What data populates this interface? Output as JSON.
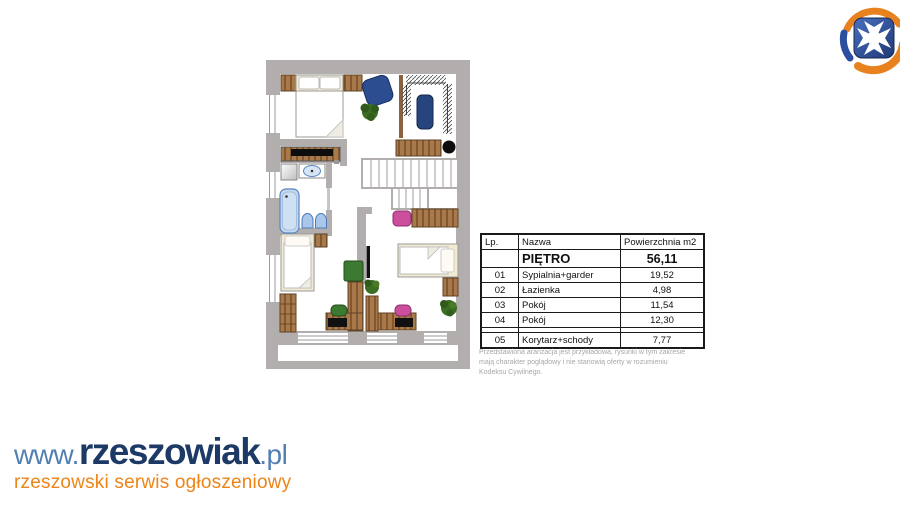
{
  "colors": {
    "wall_gray": "#b3aeae",
    "wood": "#a8794a",
    "navy": "#1d3a66",
    "steel_blue": "#527fb3",
    "orange": "#ee8418",
    "pink": "#cb4f9d",
    "green": "#3d7a31",
    "furniture_blue": "#2c4d8f",
    "bath_blue": "#c3d7ee"
  },
  "floor_plan": {
    "title": "PIĘTRO",
    "total_area_m2": "56,11"
  },
  "table": {
    "headers": [
      "Lp.",
      "Nazwa",
      "Powierzchnia m2"
    ],
    "title_row": {
      "lp": "",
      "nazwa": "PIĘTRO",
      "area": "56,11"
    },
    "rows": [
      {
        "lp": "01",
        "nazwa": "Sypialnia+garder",
        "area": "19,52"
      },
      {
        "lp": "02",
        "nazwa": "Łazienka",
        "area": "4,98"
      },
      {
        "lp": "03",
        "nazwa": "Pokój",
        "area": "11,54"
      },
      {
        "lp": "04",
        "nazwa": "Pokój",
        "area": "12,30"
      },
      {
        "lp": "05",
        "nazwa": "Korytarz+schody",
        "area": "7,77"
      }
    ]
  },
  "disclaimer": {
    "text": "Przedstawiona aranżacja jest przykładowa, rysunki w tym zakresie mają charakter poglądowy i nie stanowią oferty w rozumieniu Kodeksu Cywilnego."
  },
  "logo": {
    "www": "www.",
    "name": "rzeszowiak",
    "tld": ".pl",
    "tagline": "rzeszowski serwis ogłoszeniowy"
  }
}
